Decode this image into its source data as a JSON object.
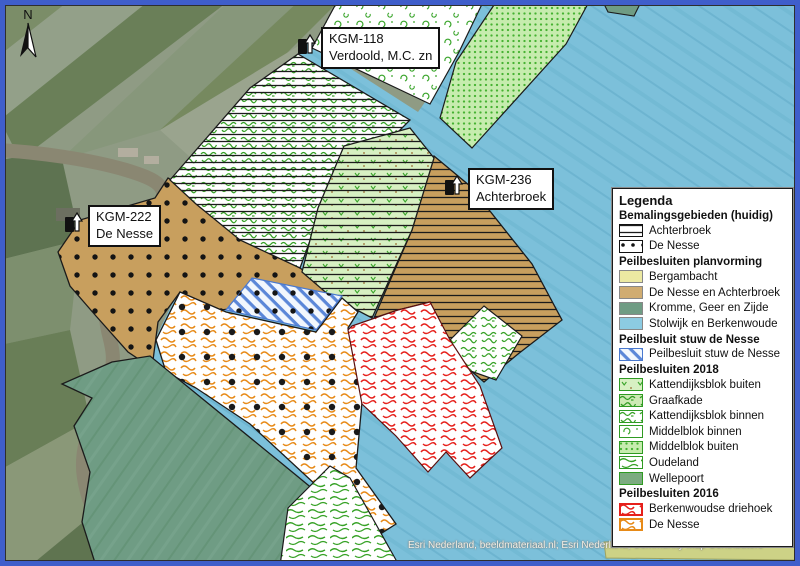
{
  "map": {
    "north_label": "N",
    "attribution": "Esri Nederland, beeldmateriaal.nl; Esri Nederland, Community Map Contributors",
    "stations": [
      {
        "id": "KGM-118",
        "name": "Verdoold, M.C. zn"
      },
      {
        "id": "KGM-222",
        "name": "De Nesse"
      },
      {
        "id": "KGM-236",
        "name": "Achterbroek"
      }
    ]
  },
  "legend": {
    "title": "Legenda",
    "sections": [
      {
        "header": "Bemalingsgebieden (huidig)",
        "items": [
          {
            "label": "Achterbroek"
          },
          {
            "label": "De Nesse"
          }
        ]
      },
      {
        "header": "Peilbesluiten planvorming",
        "items": [
          {
            "label": "Bergambacht"
          },
          {
            "label": "De Nesse en Achterbroek"
          },
          {
            "label": "Kromme, Geer en Zijde"
          },
          {
            "label": "Stolwijk en Berkenwoude"
          }
        ]
      },
      {
        "header": "Peilbesluit stuw de Nesse",
        "items": [
          {
            "label": "Peilbesluit stuw de Nesse"
          }
        ]
      },
      {
        "header": "Peilbesluiten 2018",
        "items": [
          {
            "label": "Kattendijksblok buiten"
          },
          {
            "label": "Graafkade"
          },
          {
            "label": "Kattendijksblok binnen"
          },
          {
            "label": "Middelblok binnen"
          },
          {
            "label": "Middelblok buiten"
          },
          {
            "label": "Oudeland"
          },
          {
            "label": "Wellepoort"
          }
        ]
      },
      {
        "header": "Peilbesluiten 2016",
        "items": [
          {
            "label": "Berkenwoudse driehoek"
          },
          {
            "label": "De Nesse"
          }
        ]
      }
    ]
  },
  "colors": {
    "frame_blue": "#3f5ecb",
    "stolwijk_blue": "#8ccbe2",
    "tan": "#d0ac71",
    "kromme_green": "#6f9c84",
    "bergambacht_yellow": "#ece9a2",
    "wellepoort_green": "#7cab80",
    "pattern_green": "#37a226",
    "red_2016": "#e6201b",
    "orange_2016": "#e78a17"
  }
}
